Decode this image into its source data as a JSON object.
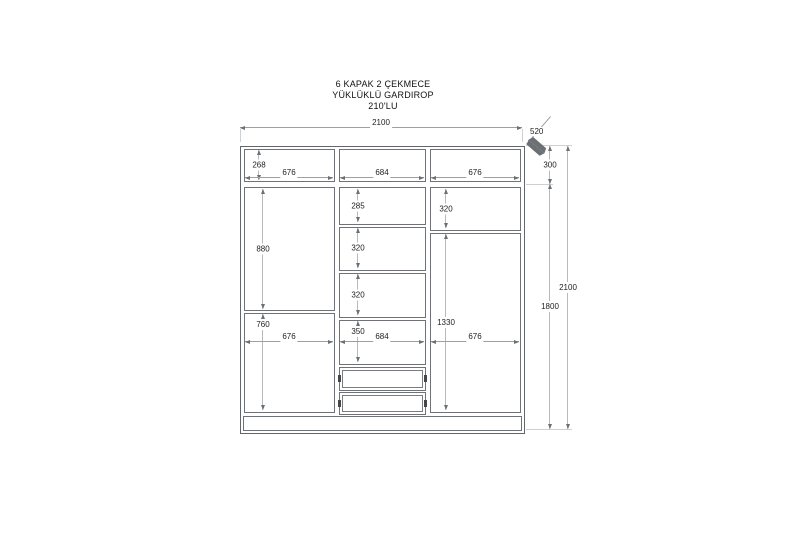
{
  "title": {
    "line1": "6 KAPAK 2 ÇEKMECE",
    "line2": "YÜKLÜKLÜ GARDIROP",
    "line3": "210'LU"
  },
  "drawing": {
    "type": "wardrobe-technical-drawing",
    "dims": {
      "overall_width": "2100",
      "depth": "520",
      "top_section_height": "300",
      "body_height": "1800",
      "overall_height": "2100",
      "top_left_inner_height": "268",
      "top_left_width": "676",
      "top_mid_width": "684",
      "top_right_width": "676",
      "left_upper_height": "880",
      "left_lower_height": "760",
      "left_door_width": "676",
      "mid_shelf1_height": "285",
      "mid_shelf2_height": "320",
      "mid_shelf3_height": "320",
      "mid_shelf4_height": "350",
      "mid_width": "684",
      "right_upper_height": "320",
      "right_lower_height": "1330",
      "right_door_width": "676"
    }
  }
}
